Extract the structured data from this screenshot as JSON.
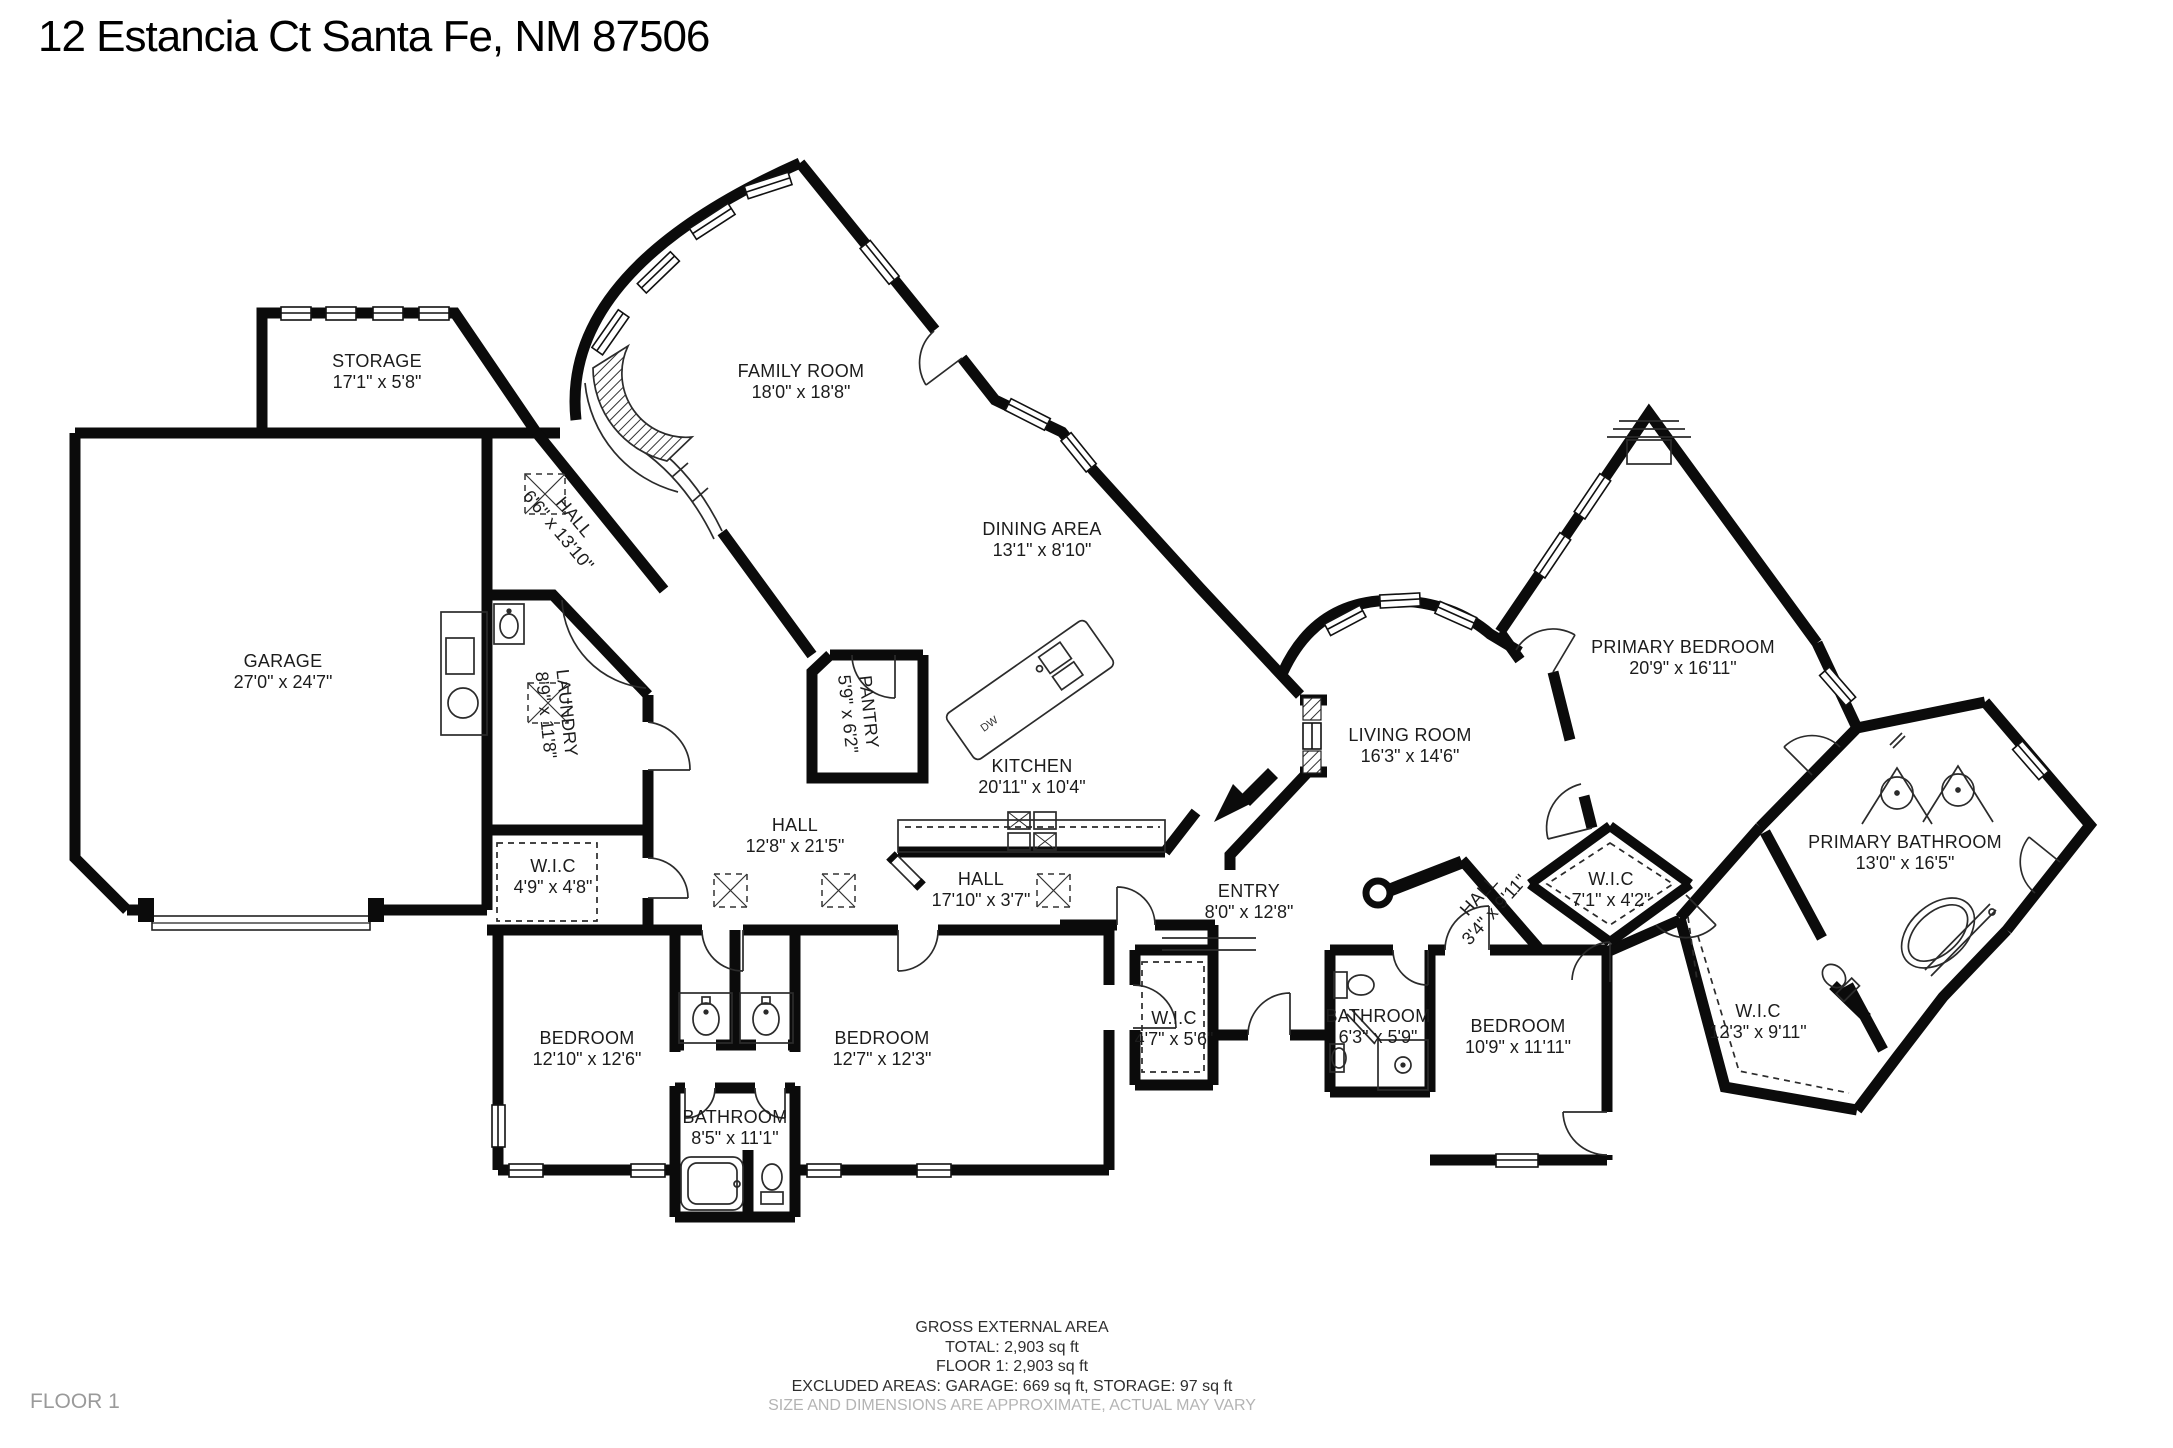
{
  "title": "12 Estancia Ct Santa Fe, NM 87506",
  "floor_label": "FLOOR 1",
  "footer": {
    "line1": "GROSS EXTERNAL AREA",
    "line2": "TOTAL: 2,903 sq ft",
    "line3": "FLOOR 1: 2,903 sq ft",
    "line4": "EXCLUDED AREAS: GARAGE: 669 sq ft, STORAGE: 97 sq ft",
    "line5": "SIZE AND DIMENSIONS ARE APPROXIMATE, ACTUAL MAY VARY"
  },
  "kitchen": {
    "island_label": "DW"
  },
  "colors": {
    "wall": "#0b0b0b",
    "text": "#1c1c1c",
    "muted_text": "#b4b4b4",
    "floor_tag": "#9a9a9a",
    "background": "#ffffff"
  },
  "rooms": [
    {
      "slug": "storage",
      "name": "STORAGE",
      "dims": "17'1\" x 5'8\"",
      "x": 377,
      "y": 372,
      "rot": 0
    },
    {
      "slug": "family-room",
      "name": "FAMILY ROOM",
      "dims": "18'0\" x 18'8\"",
      "x": 801,
      "y": 382,
      "rot": 0
    },
    {
      "slug": "hall-upper",
      "name": "HALL",
      "dims": "6'6\" x 13'10\"",
      "x": 566,
      "y": 524,
      "rot": 50
    },
    {
      "slug": "dining-area",
      "name": "DINING AREA",
      "dims": "13'1\" x 8'10\"",
      "x": 1042,
      "y": 540,
      "rot": 0
    },
    {
      "slug": "garage",
      "name": "GARAGE",
      "dims": "27'0\" x 24'7\"",
      "x": 283,
      "y": 672,
      "rot": 0
    },
    {
      "slug": "laundry",
      "name": "LAUNDRY",
      "dims": "8'9\" x 11'8\"",
      "x": 556,
      "y": 714,
      "rot": 84
    },
    {
      "slug": "pantry",
      "name": "PANTRY",
      "dims": "5'9\" x 6'2\"",
      "x": 858,
      "y": 713,
      "rot": 84
    },
    {
      "slug": "kitchen",
      "name": "KITCHEN",
      "dims": "20'11\" x 10'4\"",
      "x": 1032,
      "y": 777,
      "rot": 0
    },
    {
      "slug": "living-room",
      "name": "LIVING ROOM",
      "dims": "16'3\" x 14'6\"",
      "x": 1410,
      "y": 746,
      "rot": 0
    },
    {
      "slug": "primary-bedroom",
      "name": "PRIMARY BEDROOM",
      "dims": "20'9\" x 16'11\"",
      "x": 1683,
      "y": 658,
      "rot": 0
    },
    {
      "slug": "hall-center",
      "name": "HALL",
      "dims": "12'8\" x 21'5\"",
      "x": 795,
      "y": 836,
      "rot": 0
    },
    {
      "slug": "wic-49",
      "name": "W.I.C",
      "dims": "4'9\" x 4'8\"",
      "x": 553,
      "y": 877,
      "rot": 0
    },
    {
      "slug": "hall-south",
      "name": "HALL",
      "dims": "17'10\" x 3'7\"",
      "x": 981,
      "y": 890,
      "rot": 0
    },
    {
      "slug": "entry",
      "name": "ENTRY",
      "dims": "8'0\" x 12'8\"",
      "x": 1249,
      "y": 902,
      "rot": 0
    },
    {
      "slug": "hall-east",
      "name": "HALL",
      "dims": "3'4\" x 9'11\"",
      "x": 1487,
      "y": 903,
      "rot": -48
    },
    {
      "slug": "wic-71",
      "name": "W.I.C",
      "dims": "7'1\" x 4'2\"",
      "x": 1611,
      "y": 890,
      "rot": 0
    },
    {
      "slug": "primary-bathroom",
      "name": "PRIMARY BATHROOM",
      "dims": "13'0\" x 16'5\"",
      "x": 1905,
      "y": 853,
      "rot": 0
    },
    {
      "slug": "wic-123",
      "name": "W.I.C",
      "dims": "12'3\" x 9'11\"",
      "x": 1758,
      "y": 1022,
      "rot": 0
    },
    {
      "slug": "bedroom-1",
      "name": "BEDROOM",
      "dims": "12'10\" x 12'6\"",
      "x": 587,
      "y": 1049,
      "rot": 0
    },
    {
      "slug": "bedroom-2",
      "name": "BEDROOM",
      "dims": "12'7\" x 12'3\"",
      "x": 882,
      "y": 1049,
      "rot": 0
    },
    {
      "slug": "bathroom-center",
      "name": "BATHROOM",
      "dims": "8'5\" x 11'1\"",
      "x": 735,
      "y": 1128,
      "rot": 0
    },
    {
      "slug": "wic-47",
      "name": "W.I.C",
      "dims": "4'7\" x 5'6\"",
      "x": 1174,
      "y": 1029,
      "rot": 0
    },
    {
      "slug": "bathroom-east",
      "name": "BATHROOM",
      "dims": "6'3\" x 5'9\"",
      "x": 1378,
      "y": 1027,
      "rot": 0
    },
    {
      "slug": "bedroom-3",
      "name": "BEDROOM",
      "dims": "10'9\" x 11'11\"",
      "x": 1518,
      "y": 1037,
      "rot": 0
    }
  ]
}
